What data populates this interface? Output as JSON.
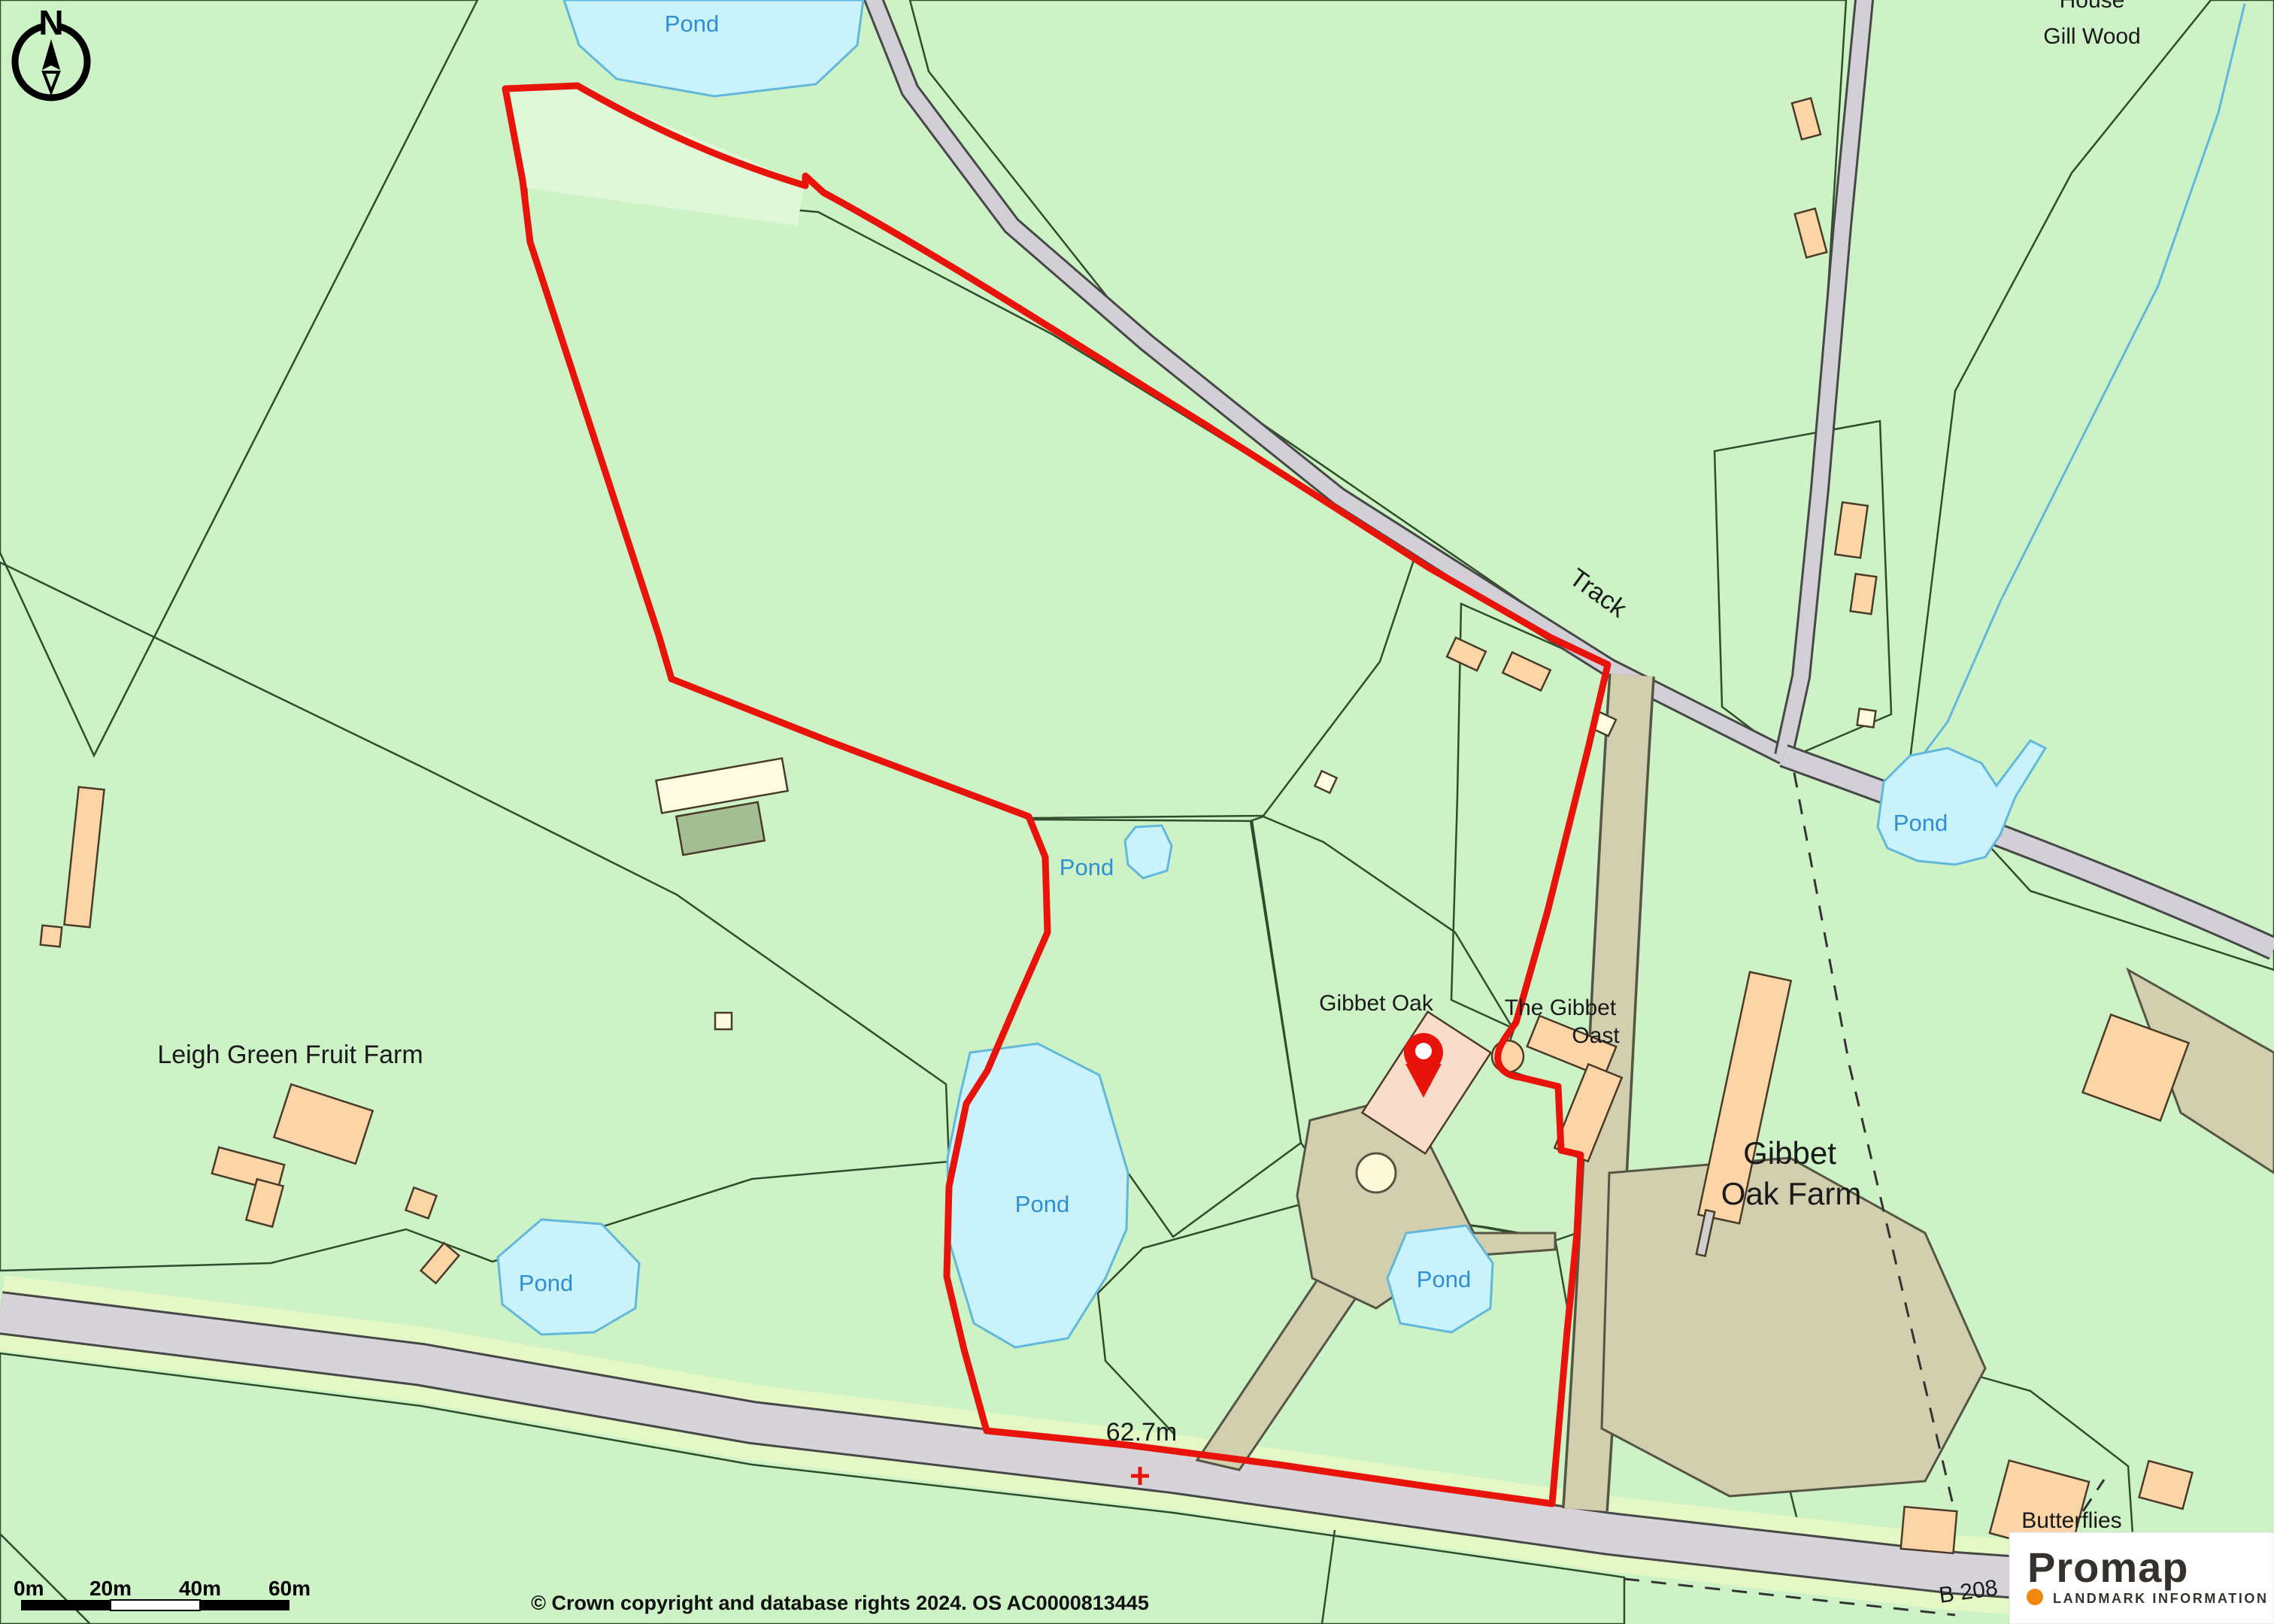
{
  "map_labels": {
    "house": "House",
    "gill_wood": "Gill Wood",
    "track": "Track",
    "leigh_green_fruit_farm": "Leigh Green Fruit Farm",
    "gibbet_oak": "Gibbet Oak",
    "the_gibbet_oast_line1": "The Gibbet",
    "the_gibbet_oast_line2": "Oast",
    "gibbet_oak_farm_line1": "Gibbet",
    "gibbet_oak_farm_line2": "Oak Farm",
    "butterflies": "Butterflies",
    "spot_height": "62.7m",
    "road_number": "B 208",
    "pond": "Pond"
  },
  "compass": {
    "letter": "N"
  },
  "scale_bar": {
    "ticks": [
      "0m",
      "20m",
      "40m",
      "60m"
    ]
  },
  "attribution": {
    "copyright": "© Crown copyright and database rights 2024. OS AC0000813445"
  },
  "logo": {
    "brand": "Promap",
    "tagline": "LANDMARK INFORMATION"
  },
  "colors": {
    "boundary_red": "#e8140c",
    "water_fill": "#c9f2fa",
    "water_outline": "#62b8dc",
    "water_label_blue": "#2e8fd5",
    "field_light_green": "#cdf2c6",
    "field_mint": "#d9f6e3",
    "field_pale_mint": "#dcf6e8",
    "woodland_olive": "#b9d2a5",
    "field_yellow": "#fcf9d2",
    "field_cream": "#fdfbe0",
    "building_peach": "#fbd5a5",
    "building_pink": "#f9dcca",
    "building_gray": "#d2d2d2",
    "road_gray": "#d6d4d9",
    "track_tan": "#d2cfaf",
    "verge_green": "#e3f8c4",
    "logo_orange": "#f0890f",
    "logo_dark": "#35322e"
  }
}
